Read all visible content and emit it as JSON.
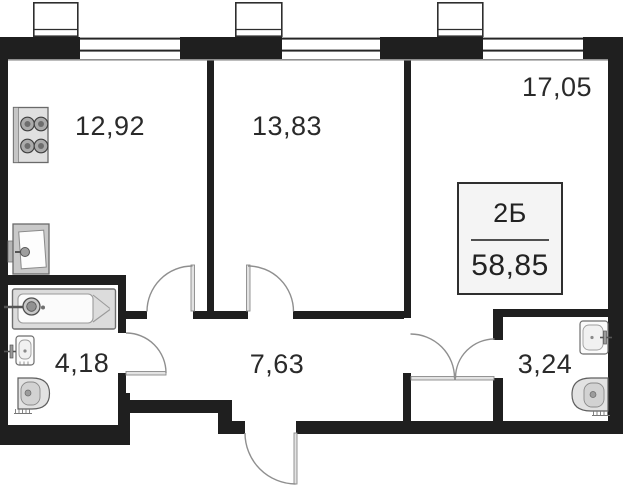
{
  "apartment": {
    "type_label": "2Б",
    "total_area": "58,85"
  },
  "rooms": [
    {
      "name": "kitchen",
      "area": "12,92"
    },
    {
      "name": "bedroom",
      "area": "13,83"
    },
    {
      "name": "living-room",
      "area": "17,05"
    },
    {
      "name": "bathroom",
      "area": "4,18"
    },
    {
      "name": "hallway",
      "area": "7,63"
    },
    {
      "name": "wc",
      "area": "3,24"
    }
  ],
  "colors": {
    "wall": "#1f1f1f",
    "door_line": "#8f8f8f",
    "fixture_fill": "#dcdcdc",
    "fixture_stroke": "#6e6e6e",
    "text": "#2a2a2a",
    "info_box_bg": "#f4f4f4",
    "info_box_border": "#2f2f2f"
  }
}
